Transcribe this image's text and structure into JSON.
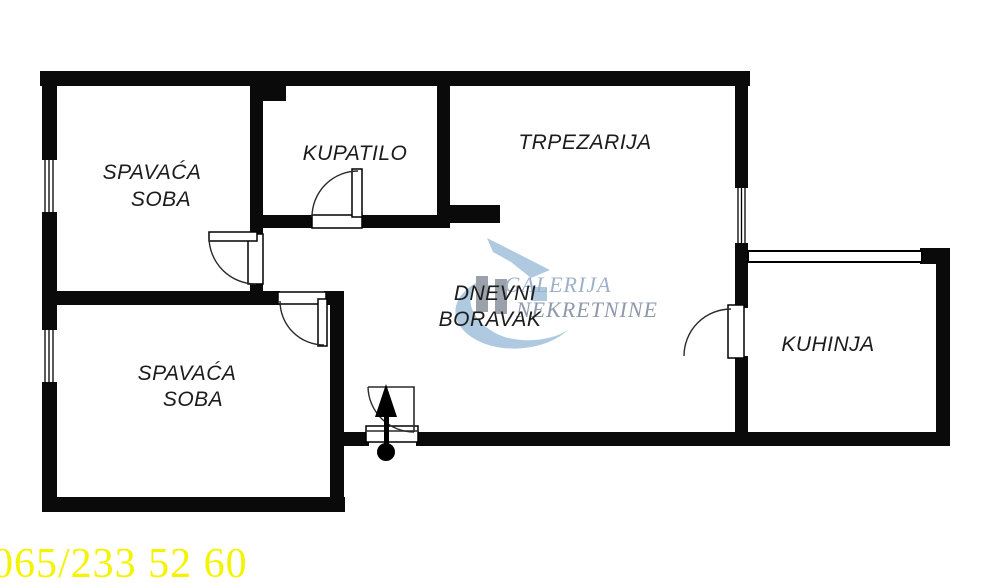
{
  "colors": {
    "background": "#ffffff",
    "wall": "#0a0a0a",
    "label": "#1c1c1c",
    "watermark_blue": "#aec9e0",
    "watermark_gray_bar": "#9aa1ab",
    "watermark_text_1": "#9fb1c9",
    "watermark_text_2": "#8e99ab",
    "phone_yellow": "#f4f400"
  },
  "rooms": {
    "bedroom_top": {
      "line1": "SPAVAĆA",
      "line2": "SOBA"
    },
    "bathroom": {
      "label": "KUPATILO"
    },
    "dining": {
      "label": "TRPEZARIJA"
    },
    "living": {
      "line1": "DNEVNI",
      "line2": "BORAVAK"
    },
    "kitchen": {
      "label": "KUHINJA"
    },
    "bedroom_bottom": {
      "line1": "SPAVAĆA",
      "line2": "SOBA"
    }
  },
  "watermark": {
    "line1": "GALERIJA",
    "line2": "NEKRETNINE"
  },
  "footer": {
    "phone": "065/233 52 60"
  }
}
